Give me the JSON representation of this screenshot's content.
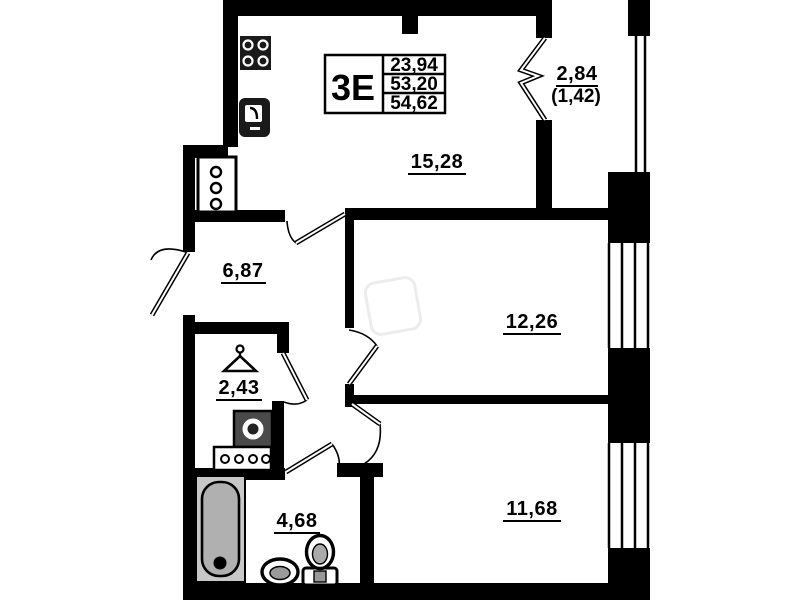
{
  "unit": {
    "type_label": "3Е",
    "values": [
      "23,94",
      "53,20",
      "54,62"
    ]
  },
  "rooms": {
    "kitchen_living": {
      "area": "15,28"
    },
    "balcony": {
      "area": "2,84",
      "area_secondary": "(1,42)"
    },
    "hallway": {
      "area": "6,87"
    },
    "bedroom_mid": {
      "area": "12,26"
    },
    "bedroom_bottom": {
      "area": "11,68"
    },
    "wardrobe": {
      "area": "2,43"
    },
    "bathroom": {
      "area": "4,68"
    }
  },
  "icons": [
    "stove-icon",
    "kitchen-sink-icon",
    "vent-shaft-icon",
    "hanger-icon",
    "washing-machine-icon",
    "shoe-cabinet-icon",
    "bathtub-icon",
    "wash-basin-icon",
    "toilet-icon",
    "accordion-balcony-door-icon"
  ],
  "colors": {
    "wall": "#000000",
    "fixture_dark": "#1a1a1a",
    "fixture_gray": "#b0b0b0",
    "tub_outer": "#c8c8c8"
  }
}
